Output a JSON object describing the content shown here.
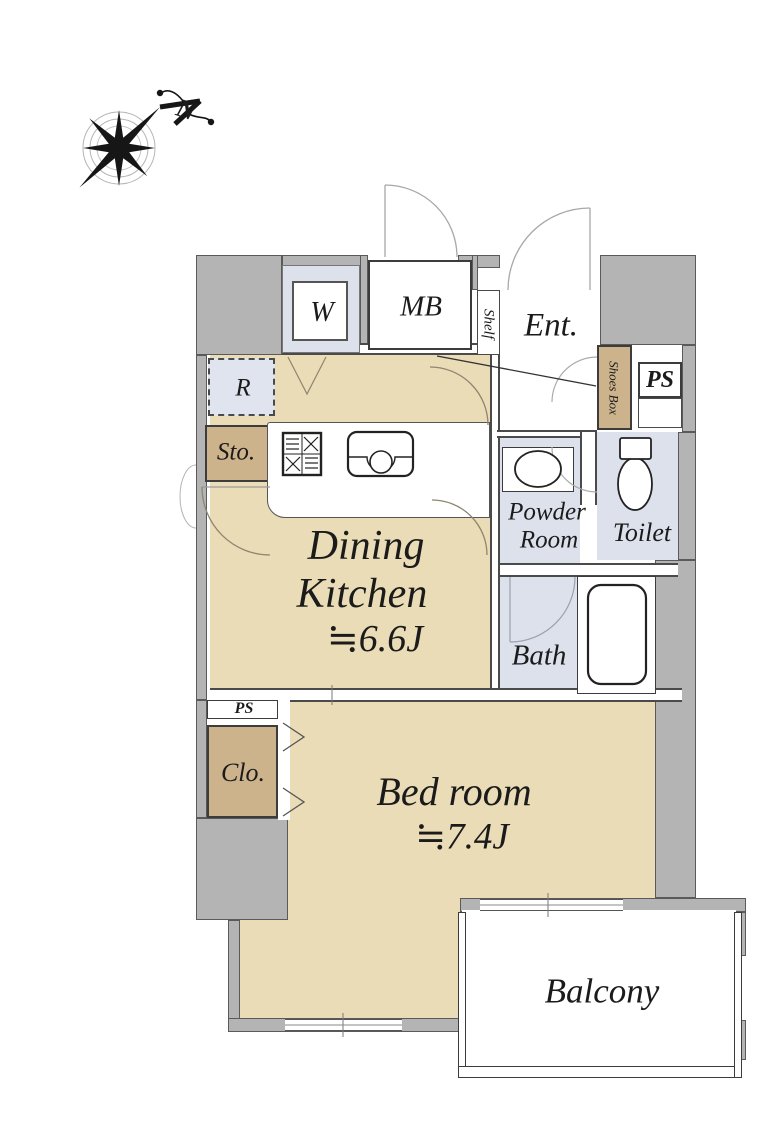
{
  "compass": {
    "north": "N"
  },
  "rooms": {
    "dining_kitchen": {
      "line1": "Dining",
      "line2": "Kitchen",
      "size": "≒6.6J"
    },
    "bedroom": {
      "name": "Bed room",
      "size": "≒7.4J"
    },
    "entrance": {
      "name": "Ent."
    },
    "powder_room": {
      "line1": "Powder",
      "line2": "Room"
    },
    "toilet": {
      "name": "Toilet"
    },
    "bath": {
      "name": "Bath"
    },
    "balcony": {
      "name": "Balcony"
    },
    "closet": {
      "name": "Clo."
    },
    "storage": {
      "name": "Sto."
    },
    "refrigerator": {
      "name": "R"
    },
    "washer": {
      "name": "W"
    },
    "meter_box": {
      "name": "MB"
    },
    "shelf": {
      "name": "Shelf"
    },
    "shoes_box": {
      "name": "Shoes Box"
    },
    "pipe_space_upper": {
      "name": "PS"
    },
    "pipe_space_lower": {
      "name": "PS"
    }
  },
  "colors": {
    "wall_gray": "#b4b4b4",
    "floor_tan": "#e9dcb6",
    "wet_lavender": "#dde1ec",
    "cabinet_brown": "#cdb38c",
    "line_dark": "#3c3c3c"
  }
}
